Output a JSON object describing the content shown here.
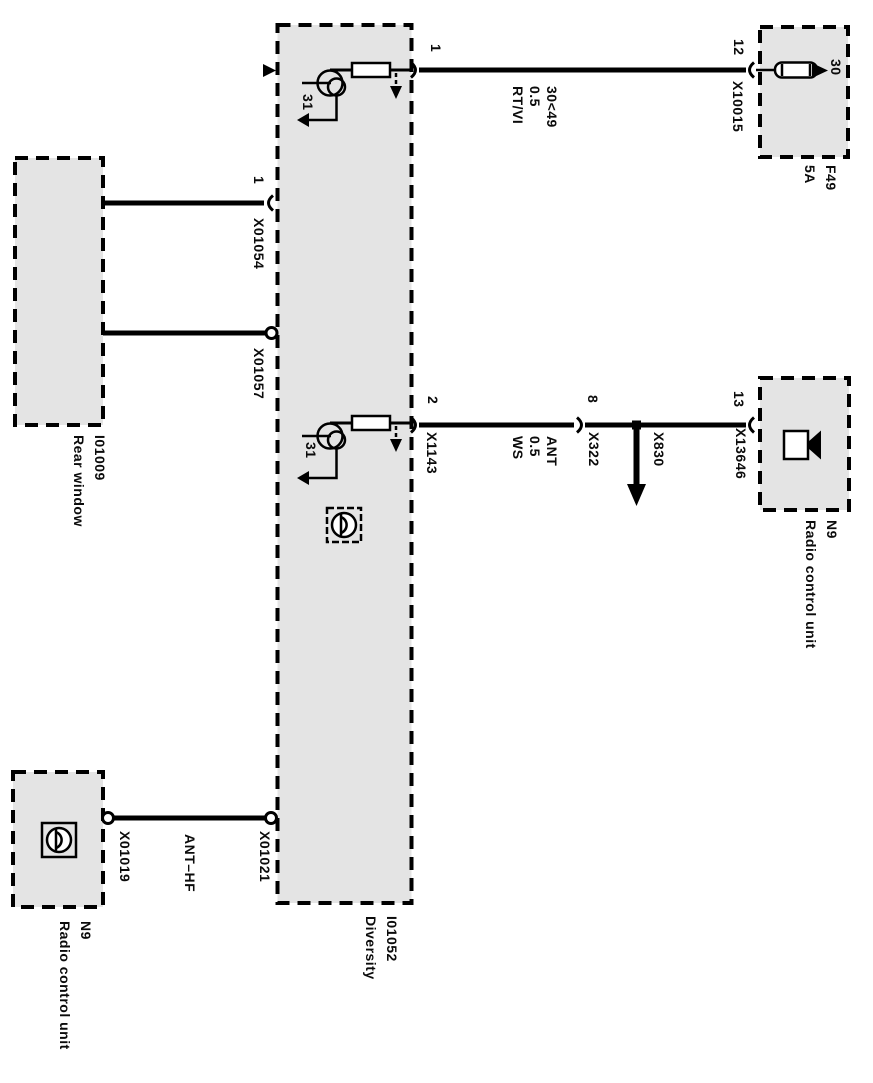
{
  "colors": {
    "background": "#ffffff",
    "box_fill": "#e4e4e4",
    "line": "#000000"
  },
  "components": {
    "diversity": {
      "label": "I01052\nDiversity"
    },
    "rear_window": {
      "label": "I01009\nRear window"
    },
    "fuse": {
      "label": "F49\n5A",
      "terminal": "30"
    },
    "radio_right": {
      "label": "N9\nRadio control unit"
    },
    "radio_bottom": {
      "label": "N9\nRadio control unit"
    }
  },
  "connectors": {
    "x10015": {
      "pin": "12",
      "label": "X10015"
    },
    "x01054": {
      "pin": "1",
      "label": "X01054"
    },
    "x01057": {
      "label": "X01057"
    },
    "x1143": {
      "pin": "2",
      "label": "X1143"
    },
    "x322": {
      "pin": "8",
      "label": "X322"
    },
    "x830": {
      "label": "X830"
    },
    "x13646": {
      "pin": "13",
      "label": "X13646"
    },
    "x01019": {
      "label": "X01019"
    },
    "x01021": {
      "label": "X01021"
    }
  },
  "wires": {
    "power": {
      "pin": "1",
      "label": "30<49\n0.5\nRT/VI"
    },
    "antenna": {
      "label": "ANT\n0.5\nWS"
    },
    "ant_hf": {
      "label": "ANT–HF"
    }
  },
  "grounds": {
    "g1": "31",
    "g2": "31"
  }
}
